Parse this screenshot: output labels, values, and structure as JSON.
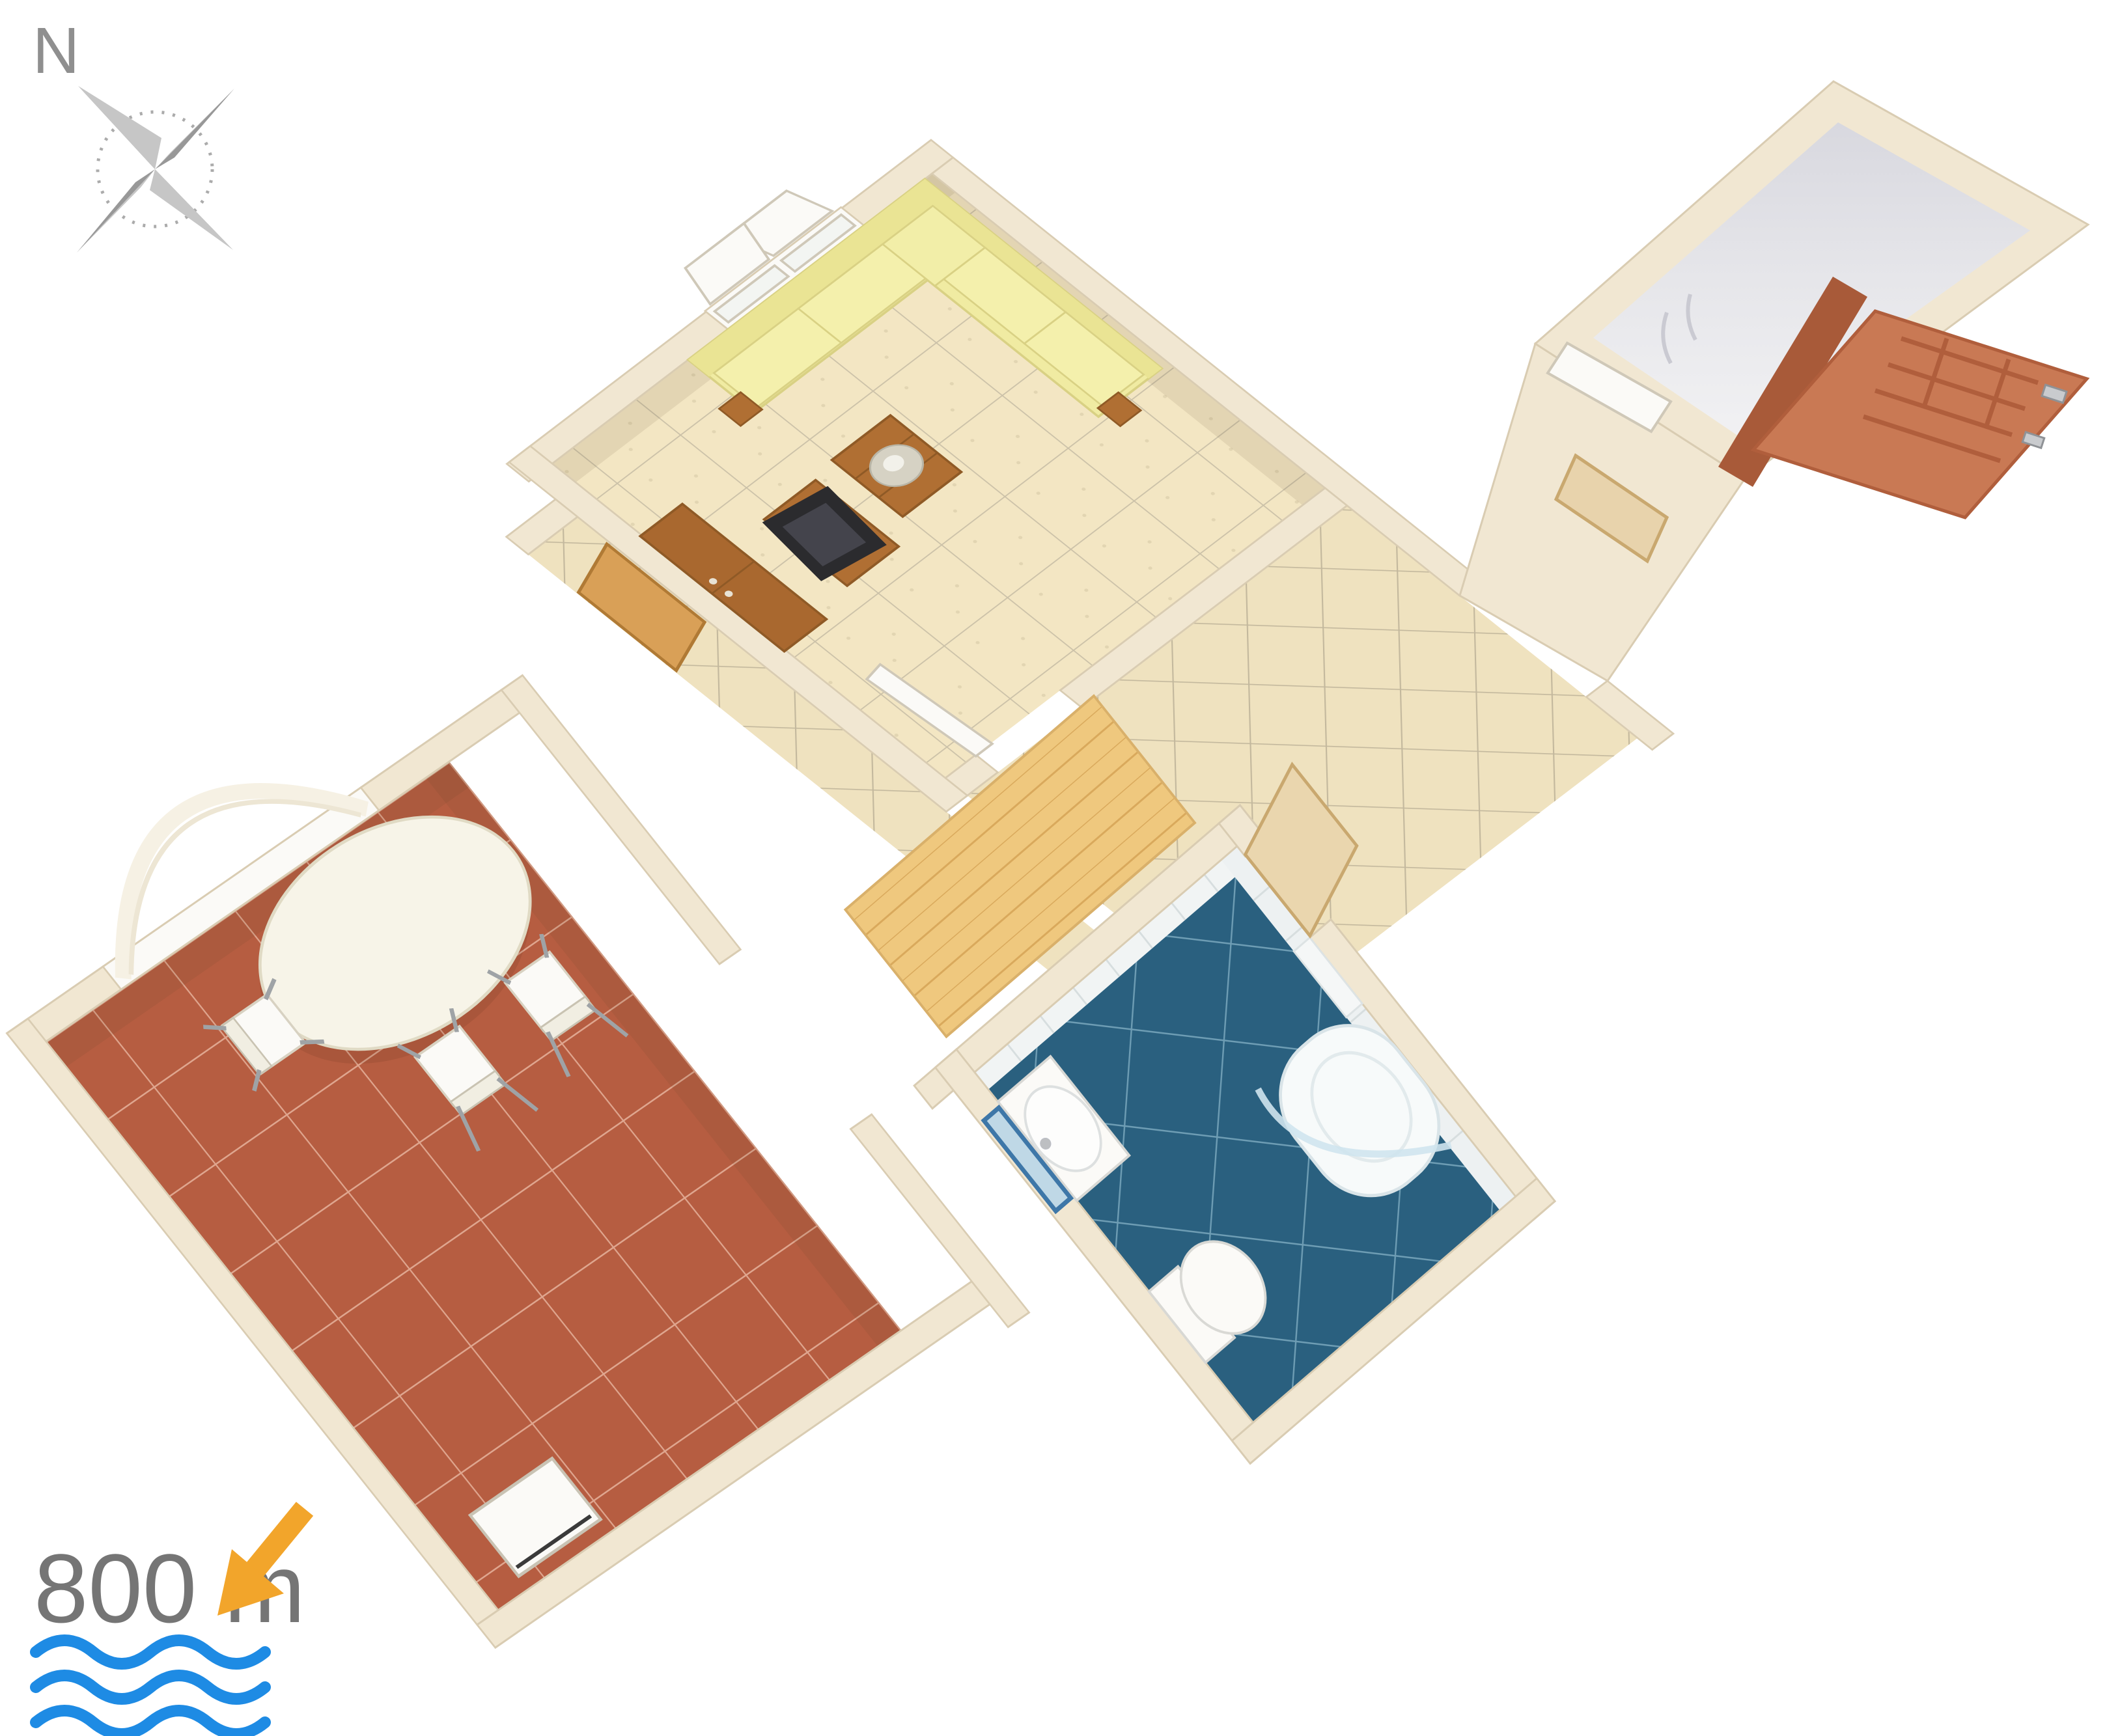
{
  "compass": {
    "label": "N"
  },
  "legend": {
    "distance": "800 m"
  },
  "palette": {
    "wall": "#F1E7D2",
    "wallEdge": "#D9CCB2",
    "wallFace": "#D8CBB1",
    "lrFloor": "#F3E6C3",
    "lrGrout": "#CBC1A8",
    "hallFloor": "#EFE2BF",
    "hallGrout": "#C3B89D",
    "terrace": "#B65D41",
    "terraceGrout": "#DFA68F",
    "bath": "#2A607F",
    "bathGrout": "#6E9DB4",
    "sofa": "#F0EBA2",
    "sofaEdge": "#D9D184",
    "wood": "#B06F33",
    "woodDark": "#8F5A26",
    "tv": "#2B2B2E",
    "white": "#FBFAF7",
    "doorOrange": "#C97954",
    "doorOrangeDark": "#A85A39",
    "entranceFloor": "#EDEDF0",
    "entranceShade": "#DDDDE3",
    "compassGray": "#ABABAB",
    "compassDark": "#989898",
    "textGray": "#757575",
    "arrowOrange": "#F2A52B",
    "waveBlue": "#1E8BE4",
    "plank": "#EFC87E",
    "plankLine": "#D9A95C",
    "glass": "#CFE4EE",
    "mirrorBlue": "#3E77A8",
    "mirrorFill": "#BFD8E6"
  }
}
